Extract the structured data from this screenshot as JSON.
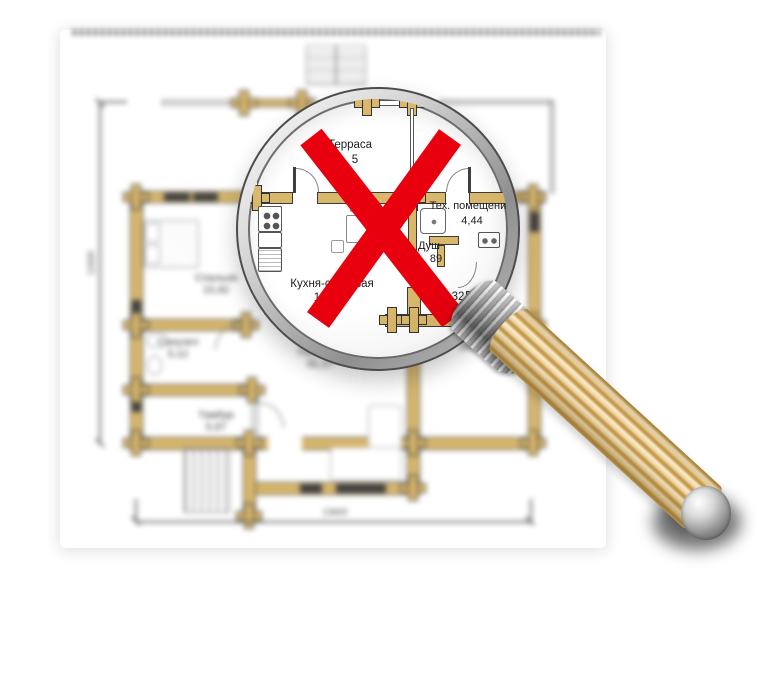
{
  "colors": {
    "wall": "#d9b76b",
    "x_red": "#e8000e",
    "handle_light": "#f8ecca",
    "handle_dark": "#c69a4e"
  },
  "magnified_view": {
    "terrace": {
      "label": "Терраса",
      "area_visible": "5"
    },
    "tech_room": {
      "label": "Тех. помещение",
      "area": "4,44"
    },
    "shower": {
      "label": "Душ",
      "area_visible": "89"
    },
    "kitchen_dining": {
      "label": "Кухня-столовая",
      "area_visible": "1"
    },
    "wc": {
      "area_visible": "32"
    },
    "sauna": {
      "label_visible": "С"
    }
  },
  "blurred_plan": {
    "bedroom": {
      "label": "Спальня",
      "area": "15,92"
    },
    "bathroom": {
      "label": "Санузел",
      "area": "5,12"
    },
    "vestibule": {
      "label": "Тамбур",
      "area": "5,97"
    },
    "living_room": {
      "label": "Гостиная",
      "area": "31,17"
    },
    "sauna": {
      "area": "16,20"
    },
    "dimensions": {
      "width_mm": "13600",
      "height_mm": "11600"
    }
  }
}
